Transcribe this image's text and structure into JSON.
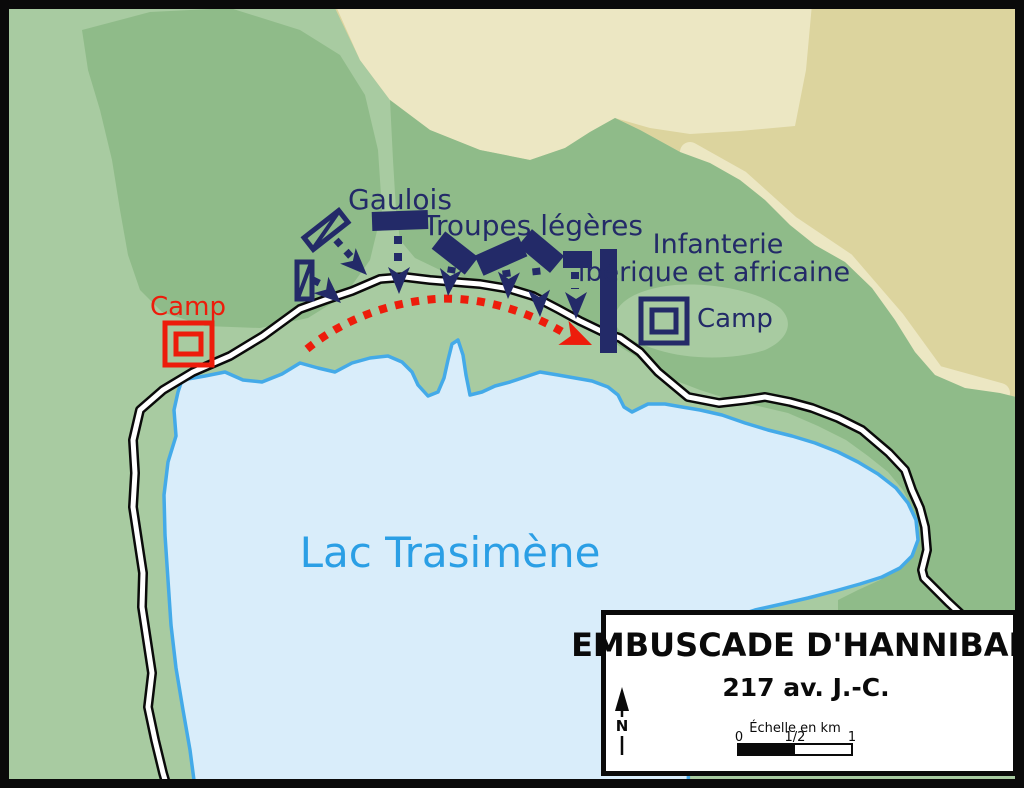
{
  "map": {
    "labels": {
      "gaulois": "Gaulois",
      "troupes_legeres": "Troupes légères",
      "infanterie_line1": "Infanterie",
      "infanterie_line2": "ibérique et africaine",
      "camp_carthaginois": "Camp",
      "camp_romain": "Camp",
      "lake": "Lac Trasimène"
    },
    "colors": {
      "army_navy": "#232A68",
      "roman_red": "#ED1C0B",
      "lake_fill": "#D9EDFA",
      "lake_outline": "#44AAE8",
      "lake_label_blue": "#2B9FE5",
      "land_light_green": "#A8CBA1",
      "hill_dark_green": "#8FBB89",
      "tan": "#DCD49E",
      "tan_light": "#ECE7C3",
      "road_white": "#FFFFFF",
      "frame_black": "#0A0A0A"
    }
  },
  "legend": {
    "title": "EMBUSCADE D'HANNIBAL",
    "date": "217 av. J.-C.",
    "north_label": "N",
    "scale_caption": "Échelle en km",
    "scale_ticks": [
      "0",
      "1/2",
      "1"
    ]
  }
}
